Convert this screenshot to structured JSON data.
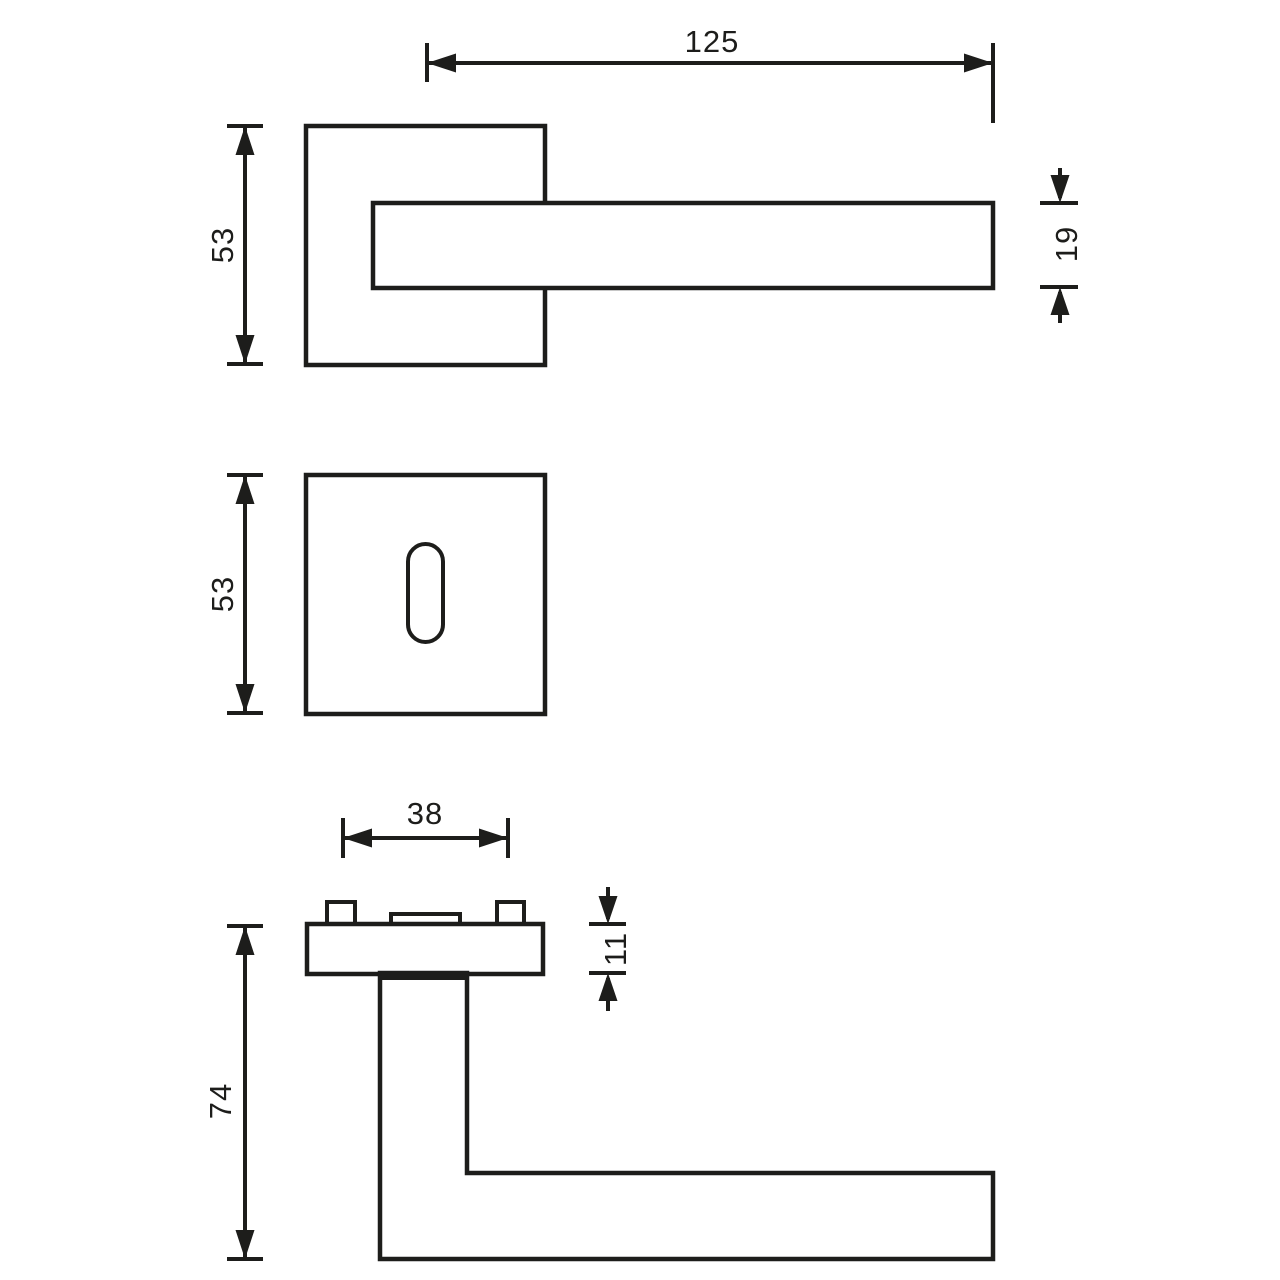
{
  "drawing": {
    "type": "technical-dimension-drawing",
    "subject": "square-rose-door-handle-with-escutcheon",
    "colors": {
      "line": "#1d1d1b",
      "background": "#ffffff"
    },
    "front_view": {
      "lever_length_label": "125",
      "rose_height_label": "53",
      "lever_thickness_label": "19"
    },
    "escutcheon_view": {
      "plate_height_label": "53"
    },
    "side_view": {
      "screw_spacing_label": "38",
      "rose_thickness_label": "11",
      "projection_label": "74"
    }
  }
}
